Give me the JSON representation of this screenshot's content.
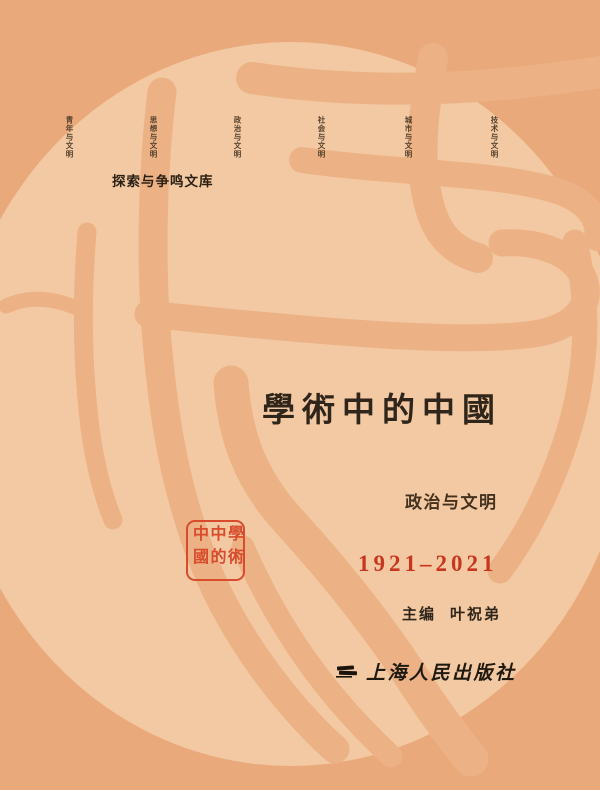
{
  "cover": {
    "categories": [
      {
        "label": "青年与文明"
      },
      {
        "label": "思想与文明"
      },
      {
        "label": "政治与文明"
      },
      {
        "label": "社会与文明"
      },
      {
        "label": "城市与文明"
      },
      {
        "label": "技术与文明"
      }
    ],
    "series": "探索与争鸣文库",
    "title": "學術中的中國",
    "subtitle": "政治与文明",
    "years": "1921–2021",
    "editor_label": "主编",
    "editor_name": "叶祝弟",
    "publisher": "上海人民出版社",
    "seal": {
      "text": "學術中的中國",
      "columns": [
        "學術",
        "中的",
        "中國"
      ]
    },
    "colors": {
      "background": "#e9a97a",
      "circle": "#f3c9a3",
      "stroke": "#ecb285",
      "title_ink": "#30251a",
      "label_ink": "#55402b",
      "accent_red": "#c7371f",
      "seal_red": "#d84b2c",
      "logo_black": "#1c150d"
    }
  }
}
